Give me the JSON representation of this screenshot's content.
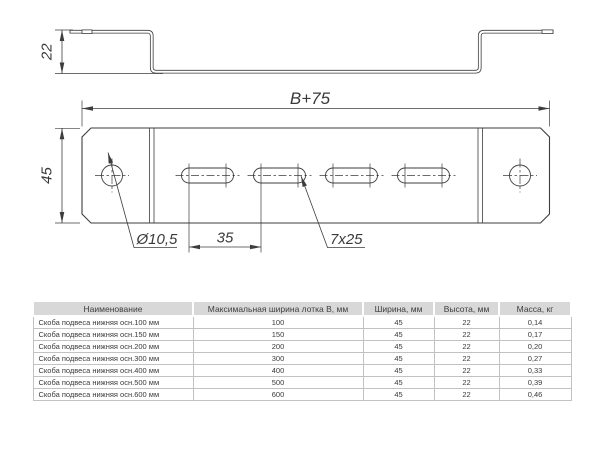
{
  "drawing": {
    "side_view": {
      "height_label": "22"
    },
    "top_view": {
      "length_label": "B+75",
      "width_label": "45",
      "hole_label": "Ø10,5",
      "pitch_label": "35",
      "slot_label": "7x25"
    }
  },
  "table": {
    "columns": [
      "Наименование",
      "Максимальная ширина лотка B, мм",
      "Ширина, мм",
      "Высота, мм",
      "Масса, кг"
    ],
    "rows": [
      [
        "Скоба подвеса нижняя осн.100 мм",
        "100",
        "45",
        "22",
        "0,14"
      ],
      [
        "Скоба подвеса нижняя осн.150 мм",
        "150",
        "45",
        "22",
        "0,17"
      ],
      [
        "Скоба подвеса нижняя осн.200 мм",
        "200",
        "45",
        "22",
        "0,20"
      ],
      [
        "Скоба подвеса нижняя осн.300 мм",
        "300",
        "45",
        "22",
        "0,27"
      ],
      [
        "Скоба подвеса нижняя осн.400 мм",
        "400",
        "45",
        "22",
        "0,33"
      ],
      [
        "Скоба подвеса нижняя осн.500 мм",
        "500",
        "45",
        "22",
        "0,39"
      ],
      [
        "Скоба подвеса нижняя осн.600 мм",
        "600",
        "45",
        "22",
        "0,46"
      ]
    ]
  },
  "colors": {
    "line": "#3d3d3d",
    "table_header_bg": "#d8d8d8",
    "table_border": "#c2c2c2",
    "text": "#3a3a3a"
  }
}
